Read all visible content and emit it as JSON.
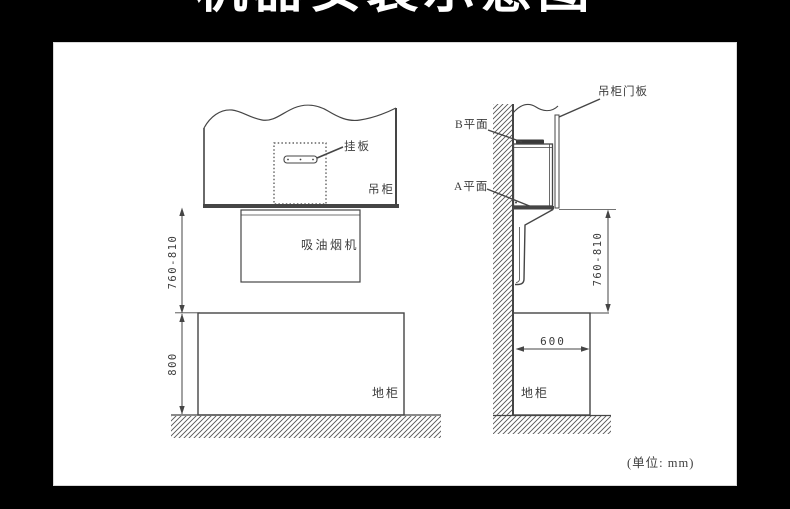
{
  "title": {
    "text": "机器安装示意图"
  },
  "unit_note": "(单位: mm)",
  "left_diagram": {
    "labels": {
      "hanging_plate": "挂板",
      "wall_cabinet": "吊柜",
      "range_hood": "吸油烟机",
      "floor_cabinet": "地柜"
    },
    "dimensions": {
      "hood_height_range": "760-810",
      "floor_cabinet_height": "800"
    }
  },
  "right_diagram": {
    "labels": {
      "cabinet_door_panel": "吊柜门板",
      "plane_b": "B平面",
      "plane_a": "A平面",
      "floor_cabinet": "地柜"
    },
    "dimensions": {
      "hood_height_range": "760-810",
      "floor_cabinet_depth": "600"
    }
  },
  "colors": {
    "background": "#000000",
    "panel": "#ffffff",
    "line_work": "#454545",
    "title_text": "#ffffff"
  }
}
